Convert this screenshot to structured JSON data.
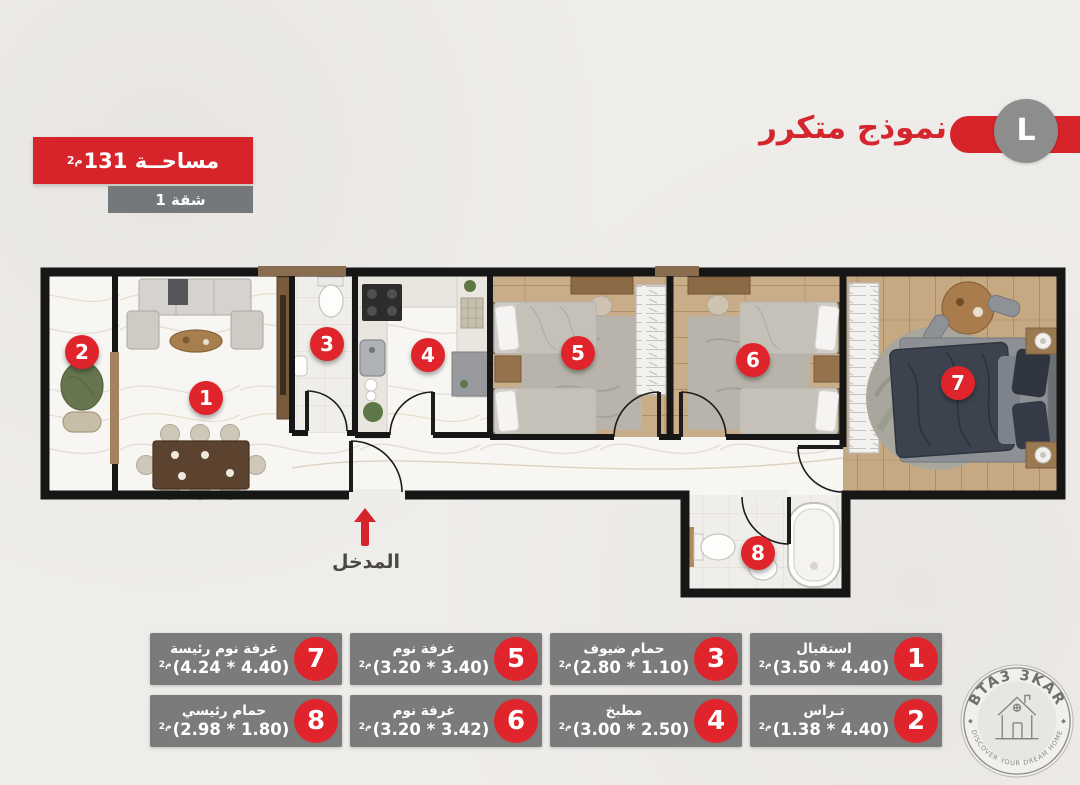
{
  "header": {
    "plan_title": "نموذج متكرر",
    "model_letter": "L",
    "area_text": "مساحــة 131",
    "area_unit": "م2",
    "unit_number": "شقة 1"
  },
  "entrance_label": "المدخل",
  "rooms": [
    {
      "num": "1",
      "name": "استقبال",
      "dims": "(3.50 * 4.40)",
      "unit": "م2"
    },
    {
      "num": "2",
      "name": "تـراس",
      "dims": "(1.38 * 4.40)",
      "unit": "م2"
    },
    {
      "num": "3",
      "name": "حمام ضيوف",
      "dims": "(2.80 * 1.10)",
      "unit": "م2"
    },
    {
      "num": "4",
      "name": "مطبخ",
      "dims": "(3.00 * 2.50)",
      "unit": "م2"
    },
    {
      "num": "5",
      "name": "غرفة نوم",
      "dims": "(3.20 * 3.40)",
      "unit": "م2"
    },
    {
      "num": "6",
      "name": "غرفة نوم",
      "dims": "(3.20 * 3.42)",
      "unit": "م2"
    },
    {
      "num": "7",
      "name": "غرفة نوم رئيسة",
      "dims": "(4.24 * 4.40)",
      "unit": "م2"
    },
    {
      "num": "8",
      "name": "حمام رئيسي",
      "dims": "(2.98 * 1.80)",
      "unit": "م2"
    }
  ],
  "logo": {
    "brand": "BTA3 3KAR",
    "tagline": "DISCOVER YOUR DREAM HOME"
  },
  "colors": {
    "accent_red": "#d7232a",
    "legend_gray": "#7b7b7b",
    "wall_black": "#161616"
  }
}
